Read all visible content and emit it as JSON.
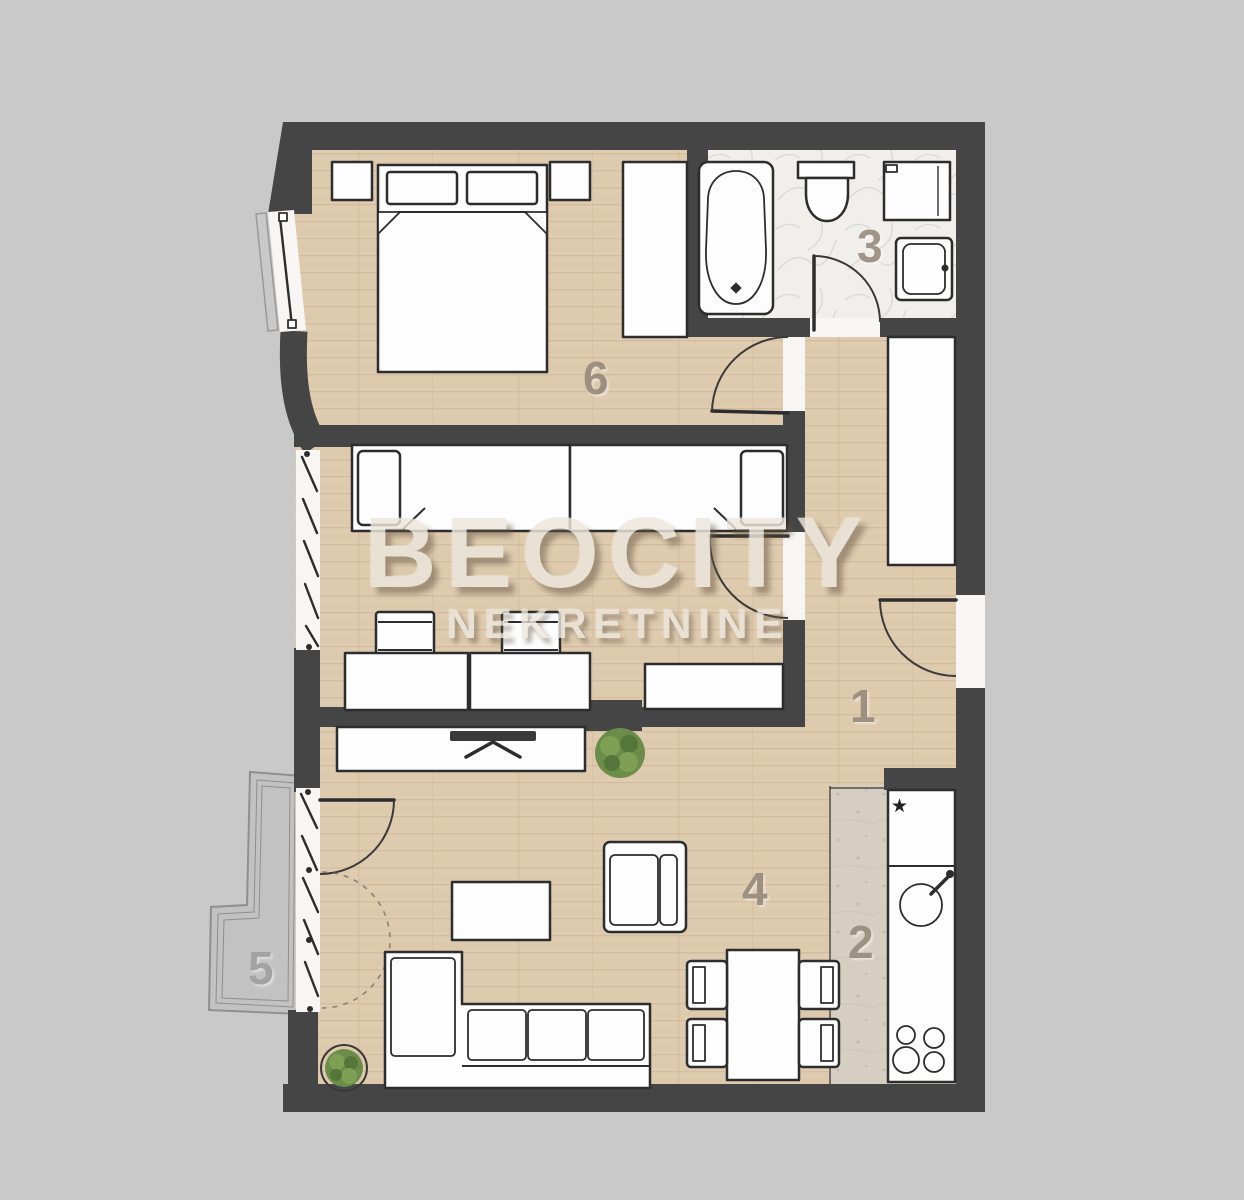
{
  "watermark": {
    "brand": "BEOCITY",
    "subtitle": "NEKRETNINE"
  },
  "rooms": [
    {
      "id": "hallway",
      "label": "1"
    },
    {
      "id": "kitchen",
      "label": "2"
    },
    {
      "id": "bathroom",
      "label": "3"
    },
    {
      "id": "living-room",
      "label": "4"
    },
    {
      "id": "terrace",
      "label": "5"
    },
    {
      "id": "bedroom",
      "label": "6"
    }
  ],
  "fixtures": {
    "fridge_star": "★"
  },
  "colors": {
    "background": "#c9c9c9",
    "wall": "#454545",
    "wood": "#dfcbaf",
    "bath": "#f0efec",
    "tile": "#d6cec0",
    "terrace": "#c2c2c2",
    "furn": "#fdfdfd",
    "outline": "#2d2d2d",
    "room-number": "#96897a",
    "watermark": "#ece7dd"
  }
}
